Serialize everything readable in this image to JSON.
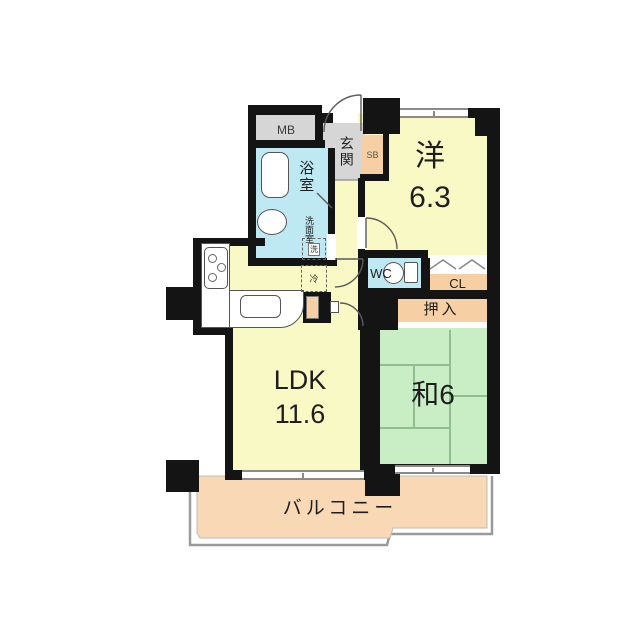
{
  "rooms": {
    "mb": {
      "label": "MB"
    },
    "bath": {
      "label": "浴室"
    },
    "washroom": {
      "label": "洗面室"
    },
    "entrance": {
      "label": "玄関"
    },
    "sb": {
      "label": "SB"
    },
    "western": {
      "label": "洋",
      "size": "6.3"
    },
    "wc": {
      "label": "WC"
    },
    "cl": {
      "label": "CL"
    },
    "oshiire": {
      "label": "押入"
    },
    "ldk": {
      "label": "LDK",
      "size": "11.6"
    },
    "washitsu": {
      "label": "和6"
    },
    "balcony": {
      "label": "バルコニー"
    }
  },
  "fixtures": {
    "washer": "洗",
    "fridge": "冷"
  },
  "colors": {
    "wall": "#141414",
    "room_yellow": "#f9f9c5",
    "wet_area_cyan": "#bfe9f2",
    "storage_peach": "#f6cfa5",
    "balcony_peach": "#f8d8b5",
    "tatami_green": "#c9eec5",
    "entrance_gray": "#d6d6d6"
  }
}
